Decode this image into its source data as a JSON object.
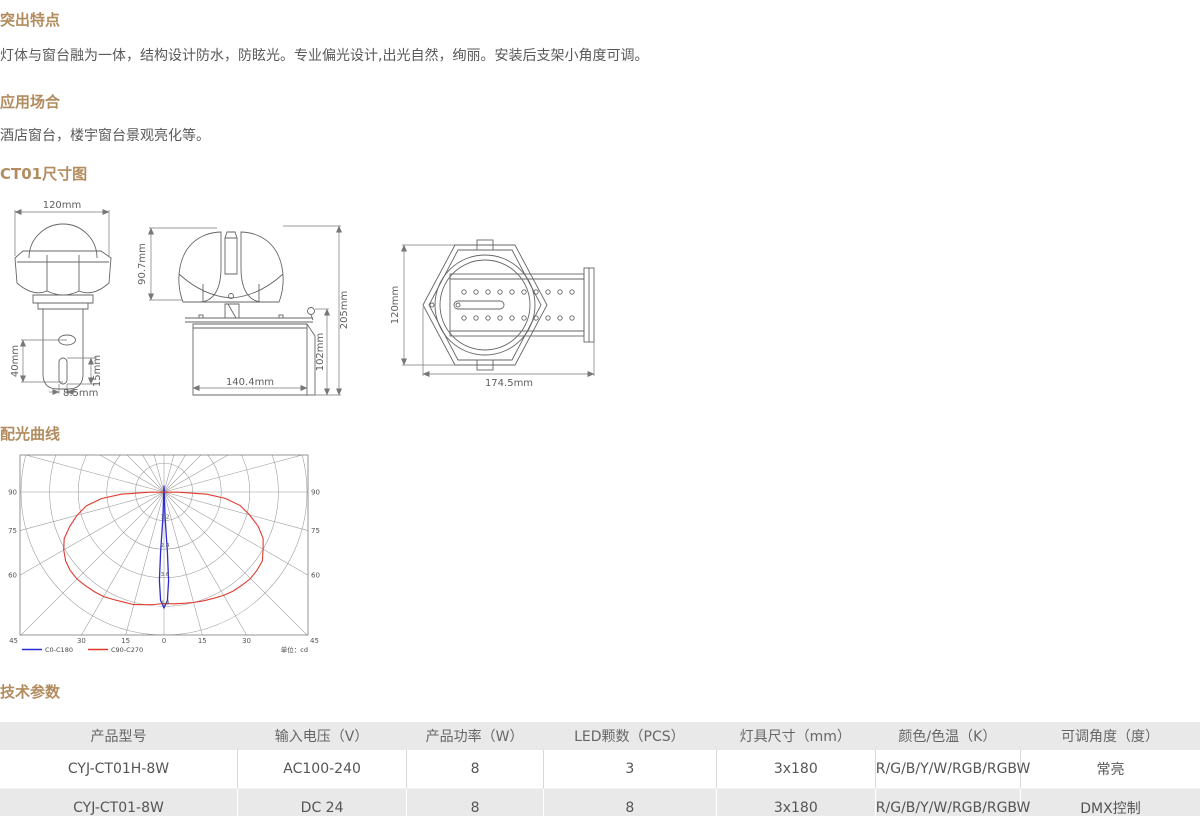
{
  "page": {
    "background_color": "#ffffff",
    "accent_heading_color": "#b28c5e"
  },
  "sections": {
    "features": {
      "title": "突出特点",
      "body": "灯体与窗台融为一体，结构设计防水，防眩光。专业偏光设计,出光自然，绚丽。安装后支架小角度可调。"
    },
    "applications": {
      "title": "应用场合",
      "body": "酒店窗台，楼宇窗台景观亮化等。"
    },
    "dimensions": {
      "title": "CT01尺寸图"
    },
    "photometry": {
      "title": "配光曲线"
    },
    "specs": {
      "title": "技术参数"
    }
  },
  "drawings": {
    "front_view": {
      "dims": {
        "width": "120mm",
        "bracket_height": "40mm",
        "slot_height": "15mm",
        "slot_width": "8.5mm"
      }
    },
    "side_view": {
      "dims": {
        "head_height": "90.7mm",
        "total_height": "205mm",
        "body_height": "102mm",
        "body_width": "140.4mm"
      }
    },
    "top_view": {
      "dims": {
        "height": "120mm",
        "length": "174.5mm"
      }
    }
  },
  "chart_data": {
    "type": "line",
    "subtype": "polar-intensity-curve",
    "title": "配光曲线",
    "unit_label": "单位：cd",
    "angle_step_deg": 15,
    "ring_ratios": [
      0.2,
      0.4,
      0.6,
      0.8,
      1.0
    ],
    "axis_ring_labels": [
      "1.2",
      "2.4",
      "3.6",
      "4.8"
    ],
    "side_angle_labels": [
      "90",
      "75",
      "60"
    ],
    "corner_angle_label": "45",
    "bottom_angle_labels": [
      "30",
      "15",
      "0"
    ],
    "legend": [
      {
        "label": "C0-C180",
        "color": "#2b2bd5"
      },
      {
        "label": "C90-C270",
        "color": "#e03a2f"
      }
    ],
    "series": [
      {
        "name": "C0-C180",
        "color": "#2b2bd5",
        "points_deg_ratio": [
          [
            180,
            0.045
          ],
          [
            -2.5,
            0.18
          ],
          [
            -3.2,
            0.42
          ],
          [
            -3.0,
            0.62
          ],
          [
            -1.8,
            0.76
          ],
          [
            0,
            0.81
          ],
          [
            1.8,
            0.76
          ],
          [
            3.0,
            0.62
          ],
          [
            3.2,
            0.42
          ],
          [
            2.5,
            0.18
          ],
          [
            180,
            0.045
          ]
        ]
      },
      {
        "name": "C90-C270",
        "color": "#e03a2f",
        "points_deg_ratio": [
          [
            -89,
            0.1
          ],
          [
            -87,
            0.3
          ],
          [
            -84,
            0.44
          ],
          [
            -80,
            0.55
          ],
          [
            -75,
            0.63
          ],
          [
            -70,
            0.7
          ],
          [
            -65,
            0.77
          ],
          [
            -60,
            0.81
          ],
          [
            -55,
            0.84
          ],
          [
            -50,
            0.855
          ],
          [
            -45,
            0.86
          ],
          [
            -40,
            0.855
          ],
          [
            -35,
            0.85
          ],
          [
            -30,
            0.845
          ],
          [
            -25,
            0.83
          ],
          [
            -20,
            0.82
          ],
          [
            -15,
            0.815
          ],
          [
            -10,
            0.8
          ],
          [
            -5,
            0.79
          ],
          [
            0,
            0.78
          ],
          [
            5,
            0.785
          ],
          [
            10,
            0.79
          ],
          [
            15,
            0.8
          ],
          [
            20,
            0.81
          ],
          [
            25,
            0.82
          ],
          [
            30,
            0.835
          ],
          [
            35,
            0.845
          ],
          [
            40,
            0.85
          ],
          [
            45,
            0.855
          ],
          [
            50,
            0.85
          ],
          [
            55,
            0.84
          ],
          [
            60,
            0.8
          ],
          [
            65,
            0.765
          ],
          [
            70,
            0.7
          ],
          [
            75,
            0.62
          ],
          [
            80,
            0.54
          ],
          [
            84,
            0.43
          ],
          [
            87,
            0.3
          ],
          [
            89,
            0.1
          ]
        ]
      }
    ]
  },
  "table": {
    "columns": [
      "产品型号",
      "输入电压（V）",
      "产品功率（W）",
      "LED颗数（PCS）",
      "灯具尺寸（mm）",
      "颜色/色温（K）",
      "可调角度（度）"
    ],
    "rows": [
      [
        "CYJ-CT01H-8W",
        "AC100-240",
        "8",
        "3",
        "3x180",
        "R/G/B/Y/W/RGB/RGBW",
        "常亮"
      ],
      [
        "CYJ-CT01-8W",
        "DC 24",
        "8",
        "8",
        "3x180",
        "R/G/B/Y/W/RGB/RGBW",
        "DMX控制"
      ]
    ]
  }
}
